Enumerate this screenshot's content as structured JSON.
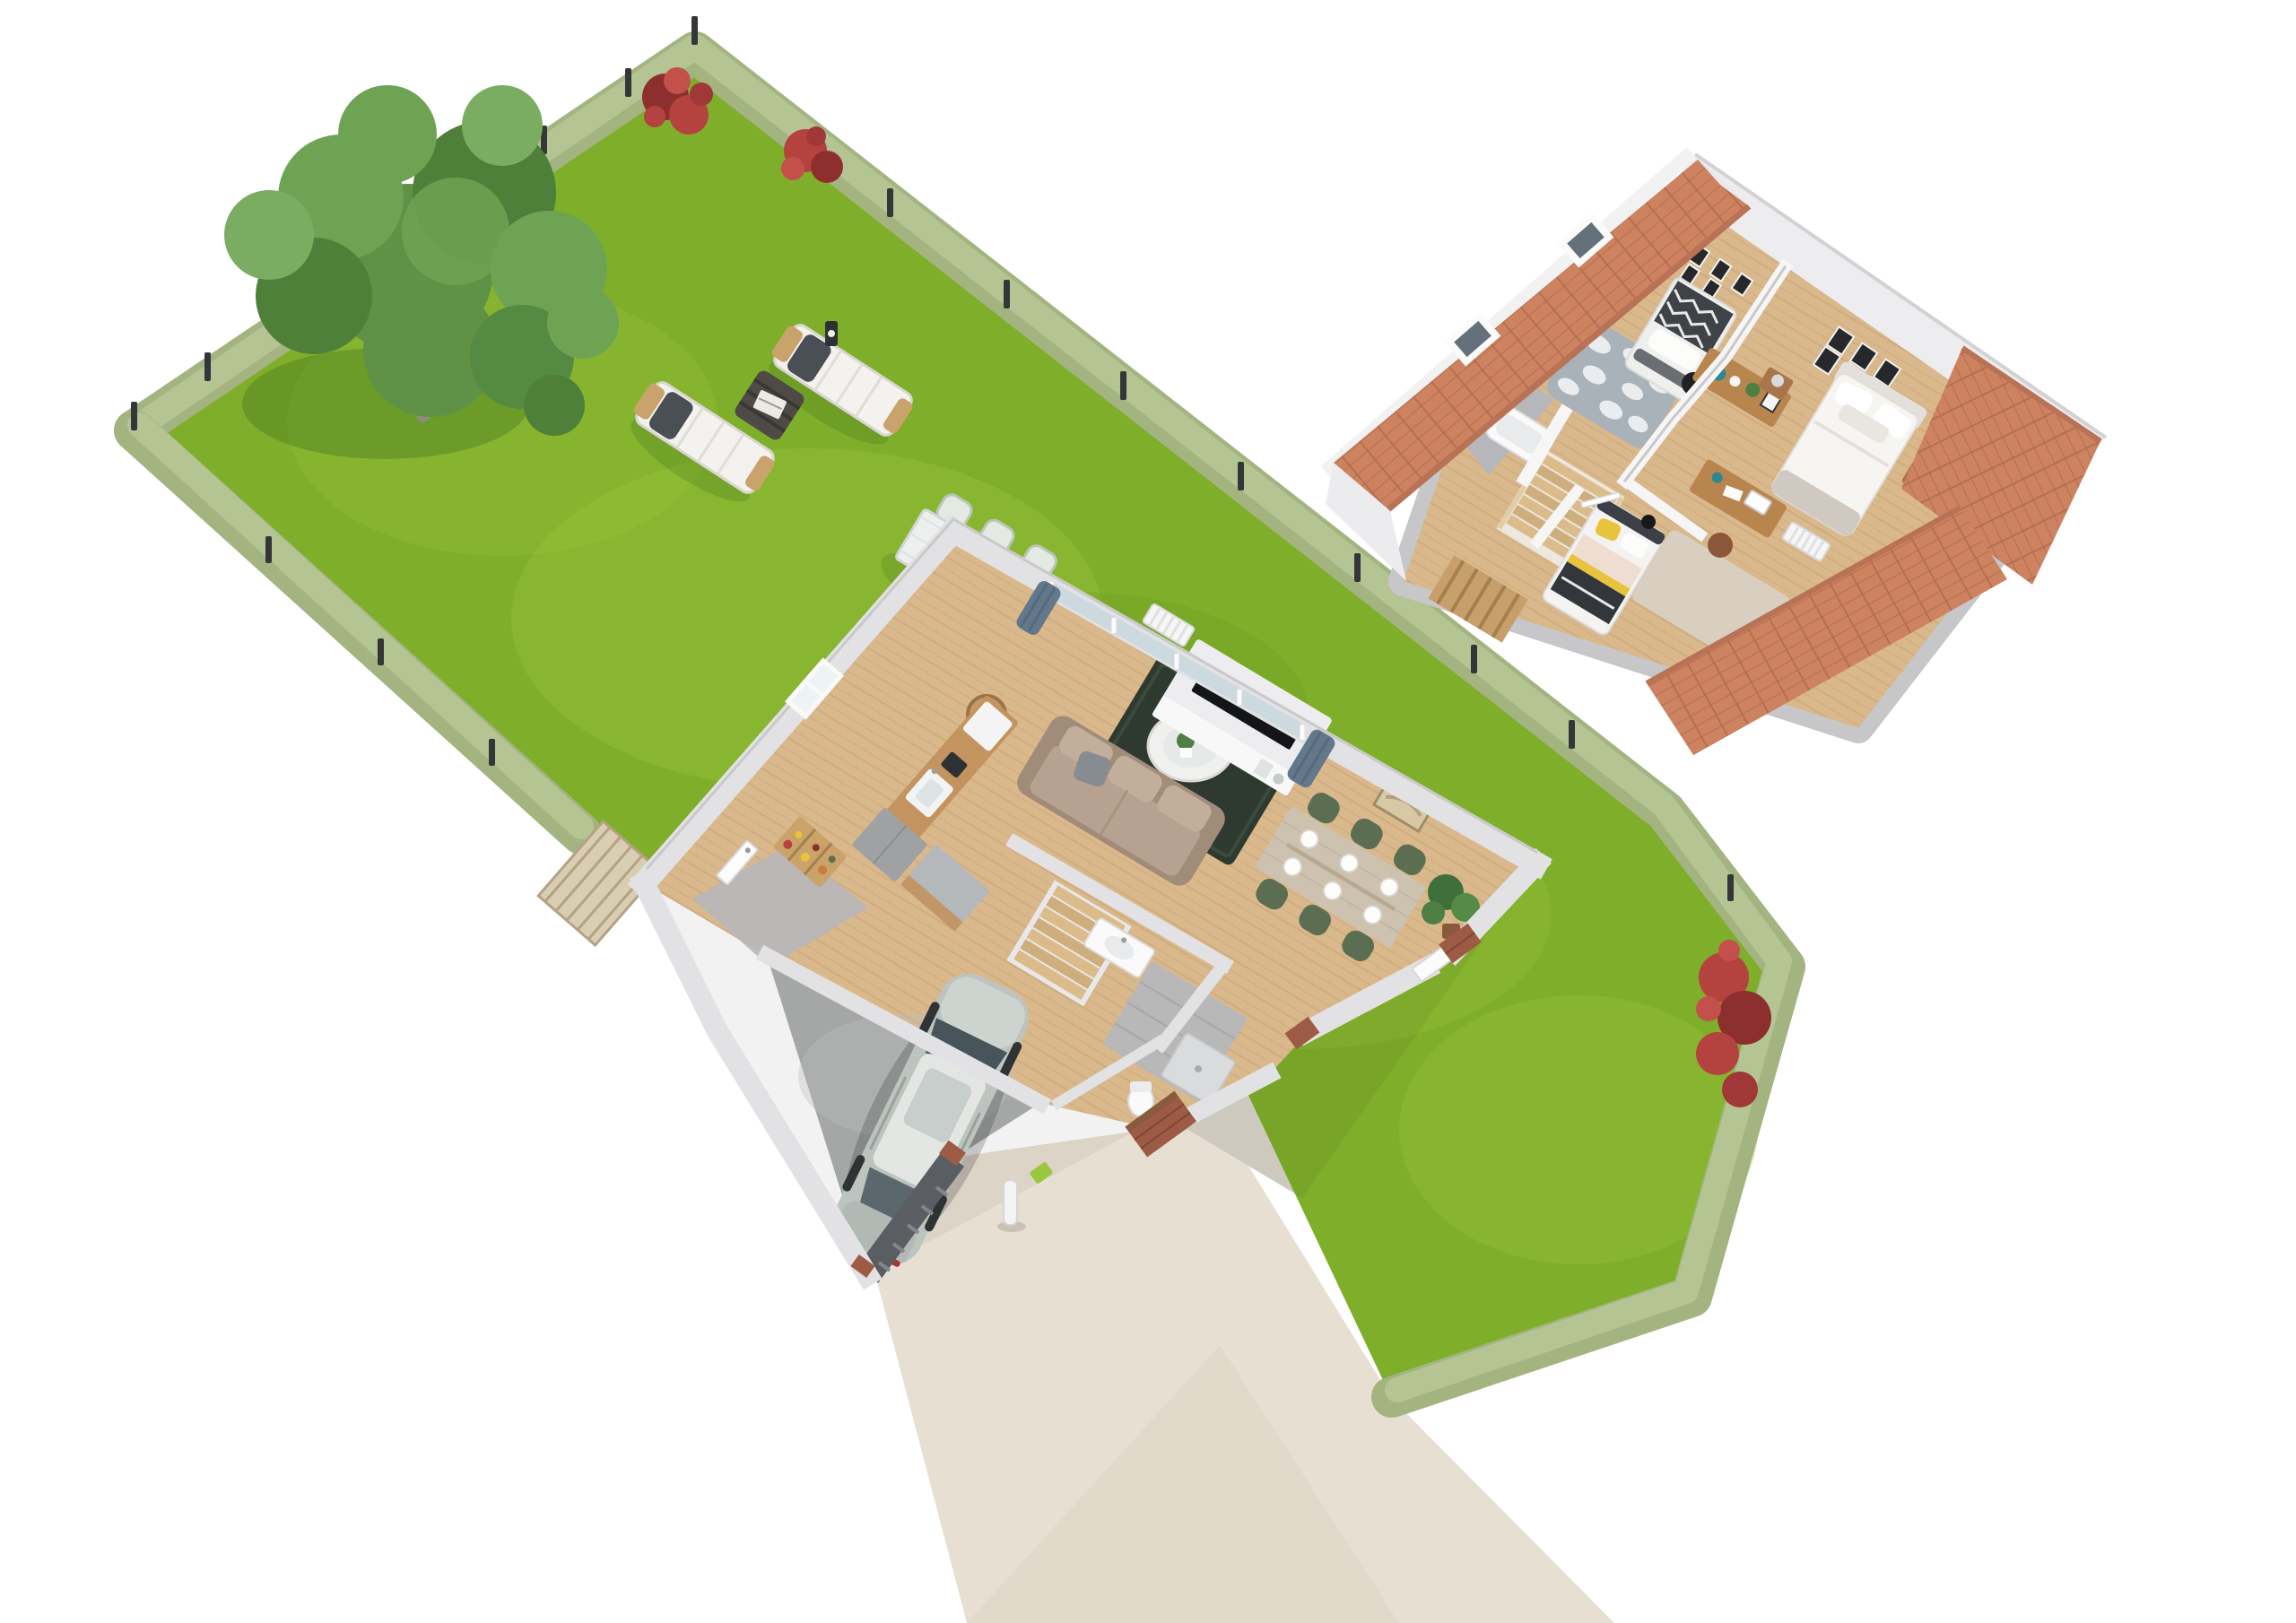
{
  "scene": {
    "title": "isometric-3d-floor-plan-house-with-garden",
    "media_type": "architectural-3d-render",
    "background": "white",
    "garden": {
      "lawn": "large-green-lawn",
      "border": "trimmed-hedge-with-fence-posts",
      "fence_post_count": 17,
      "tree": "birch-tree",
      "flowering_shrubs": 3,
      "furniture": {
        "sun_loungers": 2,
        "lounger_pillows": "dark-gray",
        "side_table": "dark-wicker-cube-with-magazine",
        "outdoor_dining_table": 1,
        "outdoor_chairs": 6,
        "table_plants": 2
      },
      "screen_panel": "wooden-trellis"
    },
    "driveway": {
      "surface": "beige-paving",
      "bollard": 1,
      "connects": [
        "garage",
        "rear-terrace",
        "street"
      ]
    },
    "ground_floor": {
      "rooms": [
        {
          "name": "living-room",
          "items": [
            "beige-sofa",
            "dark-green-rug",
            "oval-coffee-table",
            "tv",
            "media-wall",
            "media-console",
            "floor-lamp",
            "radiator",
            "wall-art",
            "patio-sliding-doors",
            "blue-gray-curtains"
          ]
        },
        {
          "name": "dining-area",
          "items": [
            "wood-dining-table",
            "6-green-chairs",
            "6-white-plates",
            "potted-plant"
          ]
        },
        {
          "name": "kitchen",
          "items": [
            "wood-counter",
            "sink",
            "coffee-machine",
            "fridge",
            "tall-cabinet",
            "island",
            "pantry-shelf",
            "window"
          ]
        },
        {
          "name": "hallway",
          "items": [
            "staircase",
            "interior-door"
          ]
        },
        {
          "name": "bathroom",
          "items": [
            "vanity-sink",
            "toilet",
            "shower",
            "gray-tile-floor"
          ]
        },
        {
          "name": "garage",
          "items": [
            "silver-car",
            "concrete-floor",
            "garage-door-sill",
            "brick-piers"
          ]
        }
      ]
    },
    "upper_floor": {
      "roof": {
        "material": "terracotta-tiles",
        "skylights": 2
      },
      "rooms": [
        {
          "name": "kids-bedroom-1",
          "items": [
            "single-bed-zigzag-blanket",
            "cloud-rug",
            "desk",
            "black-chair",
            "poster-wall"
          ]
        },
        {
          "name": "bathroom",
          "items": [
            "shower",
            "bathtub",
            "washing-machine",
            "gray-tile-floor"
          ]
        },
        {
          "name": "hallway",
          "items": [
            "wood-staircase",
            "railing",
            "wood-screen"
          ]
        },
        {
          "name": "kids-bedroom-2",
          "items": [
            "single-bed-yellow-black",
            "beige-rug",
            "desk-with-monitor",
            "brown-chair",
            "radiator"
          ]
        },
        {
          "name": "master-bedroom",
          "items": [
            "double-bed",
            "2-nightstands",
            "2-table-lamps",
            "picture-frame-gallery",
            "wood-console",
            "beige-rug"
          ]
        }
      ]
    }
  },
  "colors": {
    "bg": "#ffffff",
    "lawn": "#7fae2a",
    "lawn-light": "#9ac73d",
    "lawn-dark": "#689a1e",
    "hedge": "#a3b481",
    "hedge-light": "#b8c796",
    "hedge-dark": "#869c66",
    "post": "#33373a",
    "tree1": "#5f9147",
    "tree2": "#6ea354",
    "tree3": "#4f8039",
    "tree4": "#7aad62",
    "flower-red": "#b4423f",
    "flower-dark": "#8c2f2e",
    "wood": "#d9b88c",
    "plank-line": "#c6a070",
    "wall": "#e2e2e4",
    "wall-edge": "#c9c9cc",
    "wall-white": "#f6f6f7",
    "slab": "#c7c7ca",
    "roof": "#cd8260",
    "tile-line": "#b06a4c",
    "drive": "#e7e0d2",
    "terrace": "#d9d4ca",
    "concrete": "#a5a6a6",
    "concrete-light": "#bcbcbc",
    "car-body": "#bdc4c0",
    "car-dark": "#8e9894",
    "car-glass": "#47545a",
    "car-roof": "#e3e6e3",
    "rug-dark": "#2e3a30",
    "sofa": "#b7a190",
    "sofa-dark": "#a18b79",
    "green-chair": "#5c6e51",
    "table-wood": "#cdc1b0",
    "kitchen-wood": "#c3945f",
    "gray-cab": "#9fa1a3",
    "curtain": "#64788c",
    "glass": "#ccd9df",
    "tile-floor": "#b6b7ba",
    "shower": "#6e757b",
    "cloud-rug": "#a9b2b9",
    "rug-beige": "#d9cfc1",
    "bed-white": "#f4f3f1",
    "yellow": "#e8c43c",
    "black": "#2b2e33",
    "desk-wood": "#b9854f",
    "chair-brown": "#8a573a",
    "teal": "#2e8691",
    "brick": "#9d5b45",
    "door-sill": "#5a5e62",
    "wicker": "#4e4a46"
  }
}
